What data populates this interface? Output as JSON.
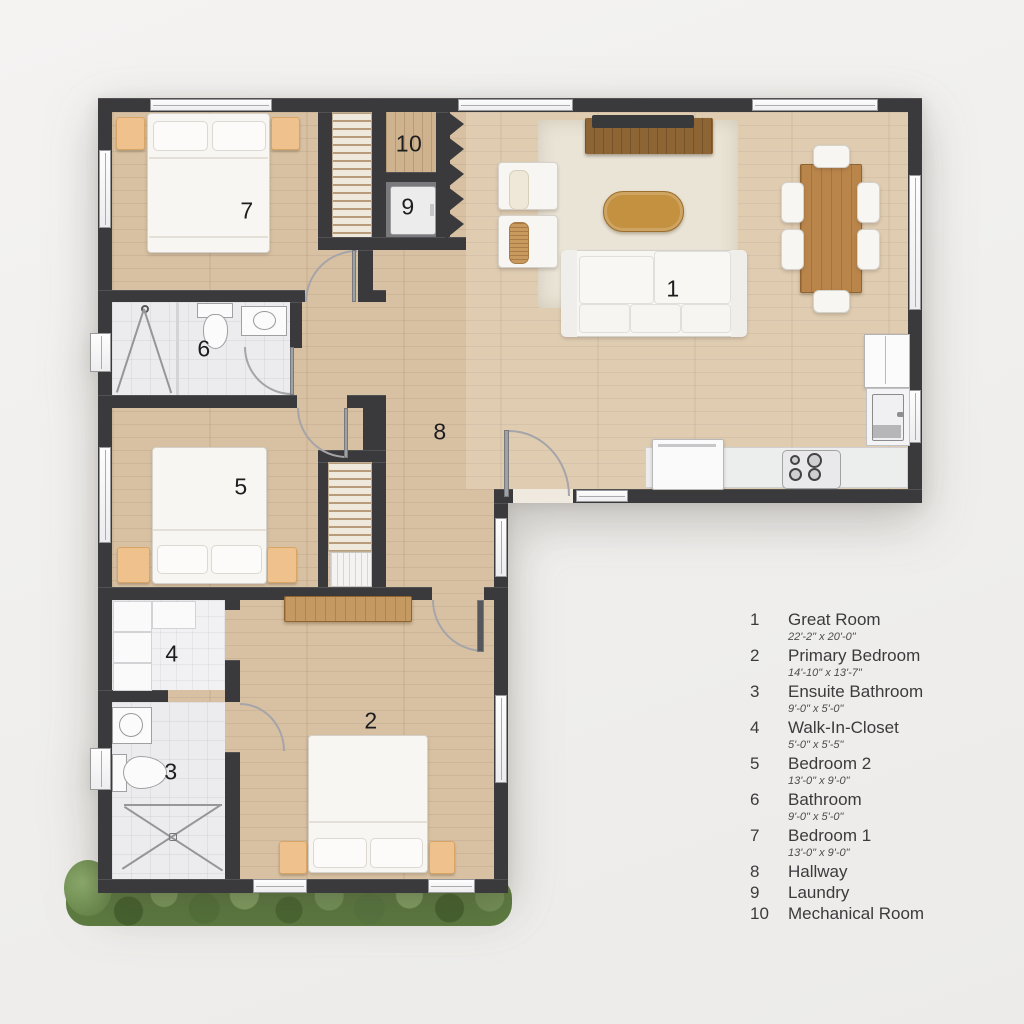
{
  "plan": {
    "type": "floor-plan",
    "shape": "L-shaped single storey"
  },
  "legend": {
    "items": [
      {
        "number": "1",
        "name": "Great Room",
        "dims": "22'-2\" x 20'-0\""
      },
      {
        "number": "2",
        "name": "Primary Bedroom",
        "dims": "14'-10\" x 13'-7\""
      },
      {
        "number": "3",
        "name": "Ensuite Bathroom",
        "dims": "9'-0\" x 5'-0\""
      },
      {
        "number": "4",
        "name": "Walk-In-Closet",
        "dims": "5'-0\" x 5'-5\""
      },
      {
        "number": "5",
        "name": "Bedroom 2",
        "dims": "13'-0\" x 9'-0\""
      },
      {
        "number": "6",
        "name": "Bathroom",
        "dims": "9'-0\" x 5'-0\""
      },
      {
        "number": "7",
        "name": "Bedroom 1",
        "dims": "13'-0\" x 9'-0\""
      },
      {
        "number": "8",
        "name": "Hallway",
        "dims": ""
      },
      {
        "number": "9",
        "name": "Laundry",
        "dims": ""
      },
      {
        "number": "10",
        "name": "Mechanical Room",
        "dims": ""
      }
    ]
  },
  "colors": {
    "wall": "#3a3a3c",
    "wood_floor": "#d8c1a2",
    "accent_wood": "#b9854a",
    "tile": "#ececee",
    "nightstand_orange": "#eec18d",
    "hedge_green": "#5d7c41",
    "background": "#f1f0ee"
  }
}
